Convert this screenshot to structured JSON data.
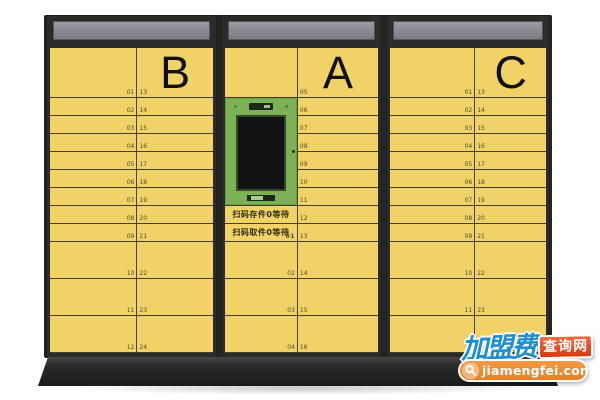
{
  "cabinets": {
    "b": {
      "letter": "B",
      "left_numbers": [
        "01",
        "02",
        "03",
        "04",
        "05",
        "06",
        "07",
        "08",
        "09",
        "10",
        "11",
        "12"
      ],
      "right_numbers": [
        "13",
        "14",
        "15",
        "16",
        "17",
        "18",
        "19",
        "20",
        "21",
        "22",
        "23",
        "24"
      ]
    },
    "a": {
      "letter": "A",
      "right_numbers": [
        "05",
        "06",
        "07",
        "08",
        "09",
        "10",
        "11",
        "12",
        "13",
        "14",
        "15",
        "16"
      ],
      "left": {
        "top_cell_number": "",
        "panel": {
          "screen_state": "off",
          "parts": [
            "scanner-slot",
            "touch-screen",
            "card-slot",
            "lock-keyhole"
          ]
        },
        "notices": [
          {
            "text": "扫码存件0等待",
            "number": ""
          },
          {
            "text": "扫码取件0等待",
            "number": "01"
          }
        ],
        "tall_numbers": [
          "02",
          "03",
          "04"
        ]
      }
    },
    "c": {
      "letter": "C",
      "left_numbers": [
        "01",
        "02",
        "03",
        "04",
        "05",
        "06",
        "07",
        "08",
        "09",
        "10",
        "11",
        "12"
      ],
      "right_numbers": [
        "13",
        "14",
        "15",
        "16",
        "17",
        "18",
        "19",
        "20",
        "21",
        "22",
        "23",
        "24"
      ]
    }
  },
  "watermark": {
    "brand_cn": "加盟费",
    "suffix_cn": "查询网",
    "domain": "jiamengfei.com",
    "icon": "magnifier"
  },
  "colors": {
    "door_yellow": "#F1D267",
    "frame_dark": "#2B2B29",
    "header_gray": "#8E8E96",
    "panel_green": "#7DB155",
    "screen_black": "#121212",
    "divider_line": "#45412A",
    "watermark_blue": "#1F8FD0",
    "watermark_red": "#D63A10",
    "watermark_orange": "#E87F22"
  }
}
